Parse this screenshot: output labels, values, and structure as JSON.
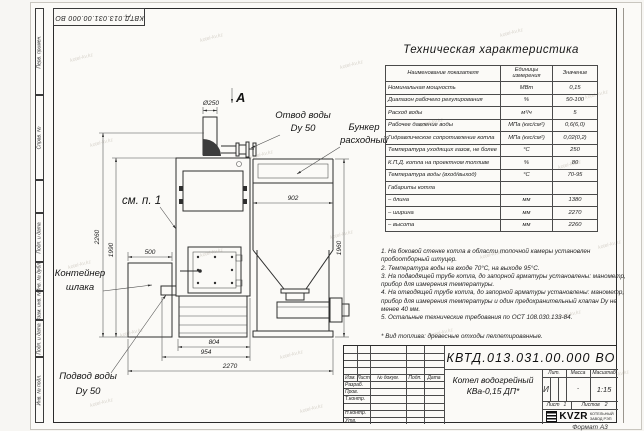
{
  "sheet": {
    "top_stamp": "КВТД.013.031.00.000 ВО",
    "format_note": "Формат А3",
    "side_boxes": [
      "Перв. примен.",
      "Справ. №",
      "",
      "Подп. и дата",
      "Инв. № дубл.",
      "Взам. инв. №",
      "Подп. и дата",
      "Инв. № подл."
    ]
  },
  "spec_table": {
    "title": "Техническая характеристика",
    "col_name": "Наименование показателя",
    "col_units": "Единицы измерения",
    "col_value": "Значение",
    "rows": [
      {
        "name": "Номинальная мощность",
        "unit": "МВт",
        "value": "0,15"
      },
      {
        "name": "Диапазон рабочего регулирования",
        "unit": "%",
        "value": "50-100"
      },
      {
        "name": "Расход воды",
        "unit": "м³/ч",
        "value": "5"
      },
      {
        "name": "Рабочее давление воды",
        "unit": "МПа (кгс/см²)",
        "value": "0,6(6,0)"
      },
      {
        "name": "Гидравлическое сопротивление котла",
        "unit": "МПа (кгс/см²)",
        "value": "0,02(0,2)"
      },
      {
        "name": "Температура уходящих газов, не более",
        "unit": "°С",
        "value": "250"
      },
      {
        "name": "К.П.Д. котла на проектном топливе",
        "unit": "%",
        "value": "80"
      },
      {
        "name": "Температура воды (вход/выход)",
        "unit": "°С",
        "value": "70-95"
      },
      {
        "name": "Габариты котла",
        "unit": "",
        "value": ""
      },
      {
        "name": "– длина",
        "unit": "мм",
        "value": "1380"
      },
      {
        "name": "– ширина",
        "unit": "мм",
        "value": "2270"
      },
      {
        "name": "– высота",
        "unit": "мм",
        "value": "2260"
      }
    ]
  },
  "notes": {
    "items": [
      "1. На боковой стенке котла в области топочной камеры установлен пробоотборный штуцер.",
      "2. Температура воды на входе 70°С, на выходе 95°С.",
      "3. На подводящей трубе котла, до запорной арматуры установлены: манометр, прибор для измерения температуры.",
      "4. На отводящей трубе котла, до запорной арматуры установлены: манометр, прибор для измерения температуры и один предохранительный клапан Dу не менее 40 мм.",
      "5. Остальные технические требования по ОСТ 108.030.133-84."
    ],
    "fuel": "* Вид топлива: древесные отходы пеллетированные."
  },
  "drawing": {
    "view_label": "A",
    "see_note": "см. п. 1",
    "labels": {
      "otvod1": "Отвод воды",
      "otvod2": "Dy 50",
      "bunker1": "Бункер",
      "bunker2": "расходный",
      "container1": "Контейнер",
      "container2": "шлака",
      "podvod1": "Подвод воды",
      "podvod2": "Dy 50"
    },
    "dims": {
      "chimney": "Ø250",
      "bunker_w": "902",
      "total_h": "2260",
      "boiler_h": "1990",
      "container_w": "500",
      "bunker_h": "1960",
      "boiler_w": "804",
      "boiler_w2": "954",
      "total_w": "2270"
    }
  },
  "title_block": {
    "designation": "КВТД.013.031.00.000 ВО",
    "name1": "Котел водогрейный",
    "name2": "КВа-0,15 ДП*",
    "cols": [
      "Изм.",
      "Лист",
      "№ докум.",
      "Подп.",
      "Дата"
    ],
    "roles": [
      "Разраб.",
      "Пров.",
      "Т.контр.",
      "Н.контр.",
      "Утв."
    ],
    "lit_h": "Лит.",
    "mass_h": "Масса",
    "scale_h": "Масштаб",
    "lit": "И",
    "mass": "-",
    "scale": "1:15",
    "sheet_h": "Лист",
    "sheet": "1",
    "sheets_h": "Листов",
    "sheets": "2",
    "logo": "KVZR",
    "company1": "КОТЕЛЬНЫЙ",
    "company2": "ЗАВОД РЭП"
  },
  "watermark": {
    "text": "kotel-kv.kz",
    "positions": [
      [
        70,
        55
      ],
      [
        200,
        35
      ],
      [
        340,
        62
      ],
      [
        500,
        30
      ],
      [
        585,
        92
      ],
      [
        90,
        140
      ],
      [
        250,
        152
      ],
      [
        420,
        120
      ],
      [
        558,
        162
      ],
      [
        68,
        262
      ],
      [
        200,
        250
      ],
      [
        330,
        232
      ],
      [
        480,
        252
      ],
      [
        598,
        242
      ],
      [
        120,
        330
      ],
      [
        280,
        352
      ],
      [
        430,
        330
      ],
      [
        558,
        312
      ],
      [
        90,
        400
      ],
      [
        300,
        406
      ],
      [
        500,
        402
      ],
      [
        606,
        372
      ]
    ]
  }
}
